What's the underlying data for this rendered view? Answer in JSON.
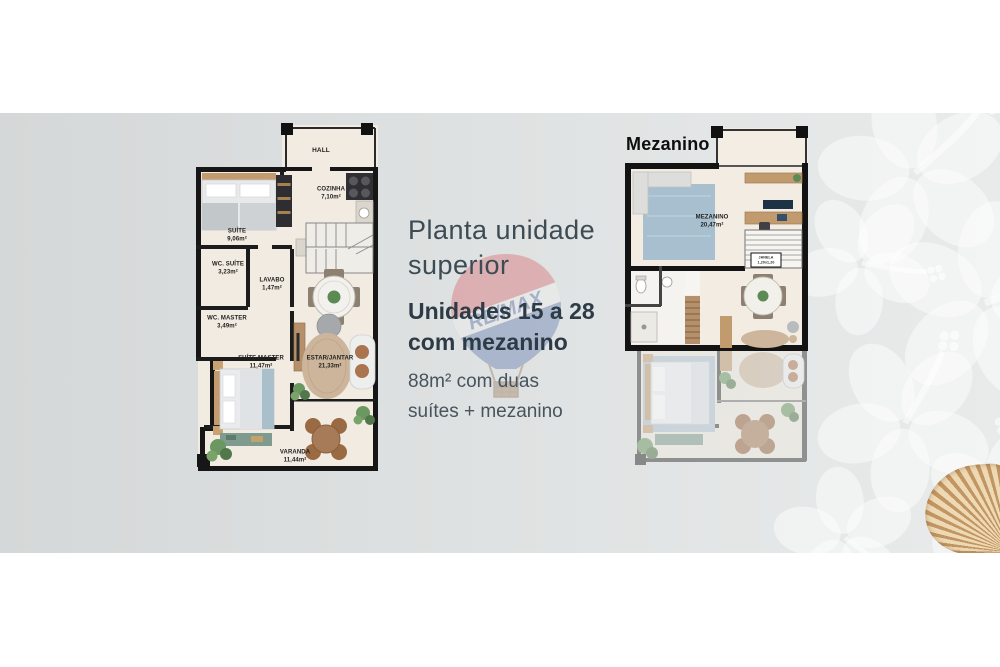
{
  "page": {
    "colors": {
      "band_left": "#d5d8d8",
      "band_right": "#e9ebeb",
      "wall": "#161616",
      "floor": "#f2ece3",
      "text_navy": "#2d3b47"
    }
  },
  "description": {
    "title_line1": "Planta unidade",
    "title_line2": "superior",
    "units_line1": "Unidades 15 a 28",
    "units_line2": "com mezanino",
    "detail_line1": "88m² com duas",
    "detail_line2": "suítes + mezanino"
  },
  "watermark": {
    "label": "RE/MAX",
    "red": "#d64046",
    "blue": "#33549a"
  },
  "left_plan": {
    "rooms": {
      "hall": {
        "name": "HALL",
        "area": ""
      },
      "cozinha": {
        "name": "COZINHA",
        "area": "7,10m²"
      },
      "suite": {
        "name": "SUÍTE",
        "area": "9,06m²"
      },
      "wc_suite": {
        "name": "WC. SUÍTE",
        "area": "3,23m²"
      },
      "lavabo": {
        "name": "LAVABO",
        "area": "1,47m²"
      },
      "wc_master": {
        "name": "WC. MASTER",
        "area": "3,49m²"
      },
      "suite_master": {
        "name": "SUÍTE MASTER",
        "area": "11,47m²"
      },
      "estar_jantar": {
        "name": "ESTAR/JANTAR",
        "area": "21,33m²"
      },
      "varanda": {
        "name": "VARANDA",
        "area": "11,44m²"
      }
    }
  },
  "right_plan": {
    "title": "Mezanino",
    "rooms": {
      "mezanino": {
        "name": "MEZANINO",
        "area": "20,47m²"
      },
      "janela": {
        "name": "JANELA",
        "area": "1,20x1,20"
      }
    }
  },
  "decor": {
    "flower_icon": "hibiscus-flower",
    "shell_icon": "seashell"
  }
}
